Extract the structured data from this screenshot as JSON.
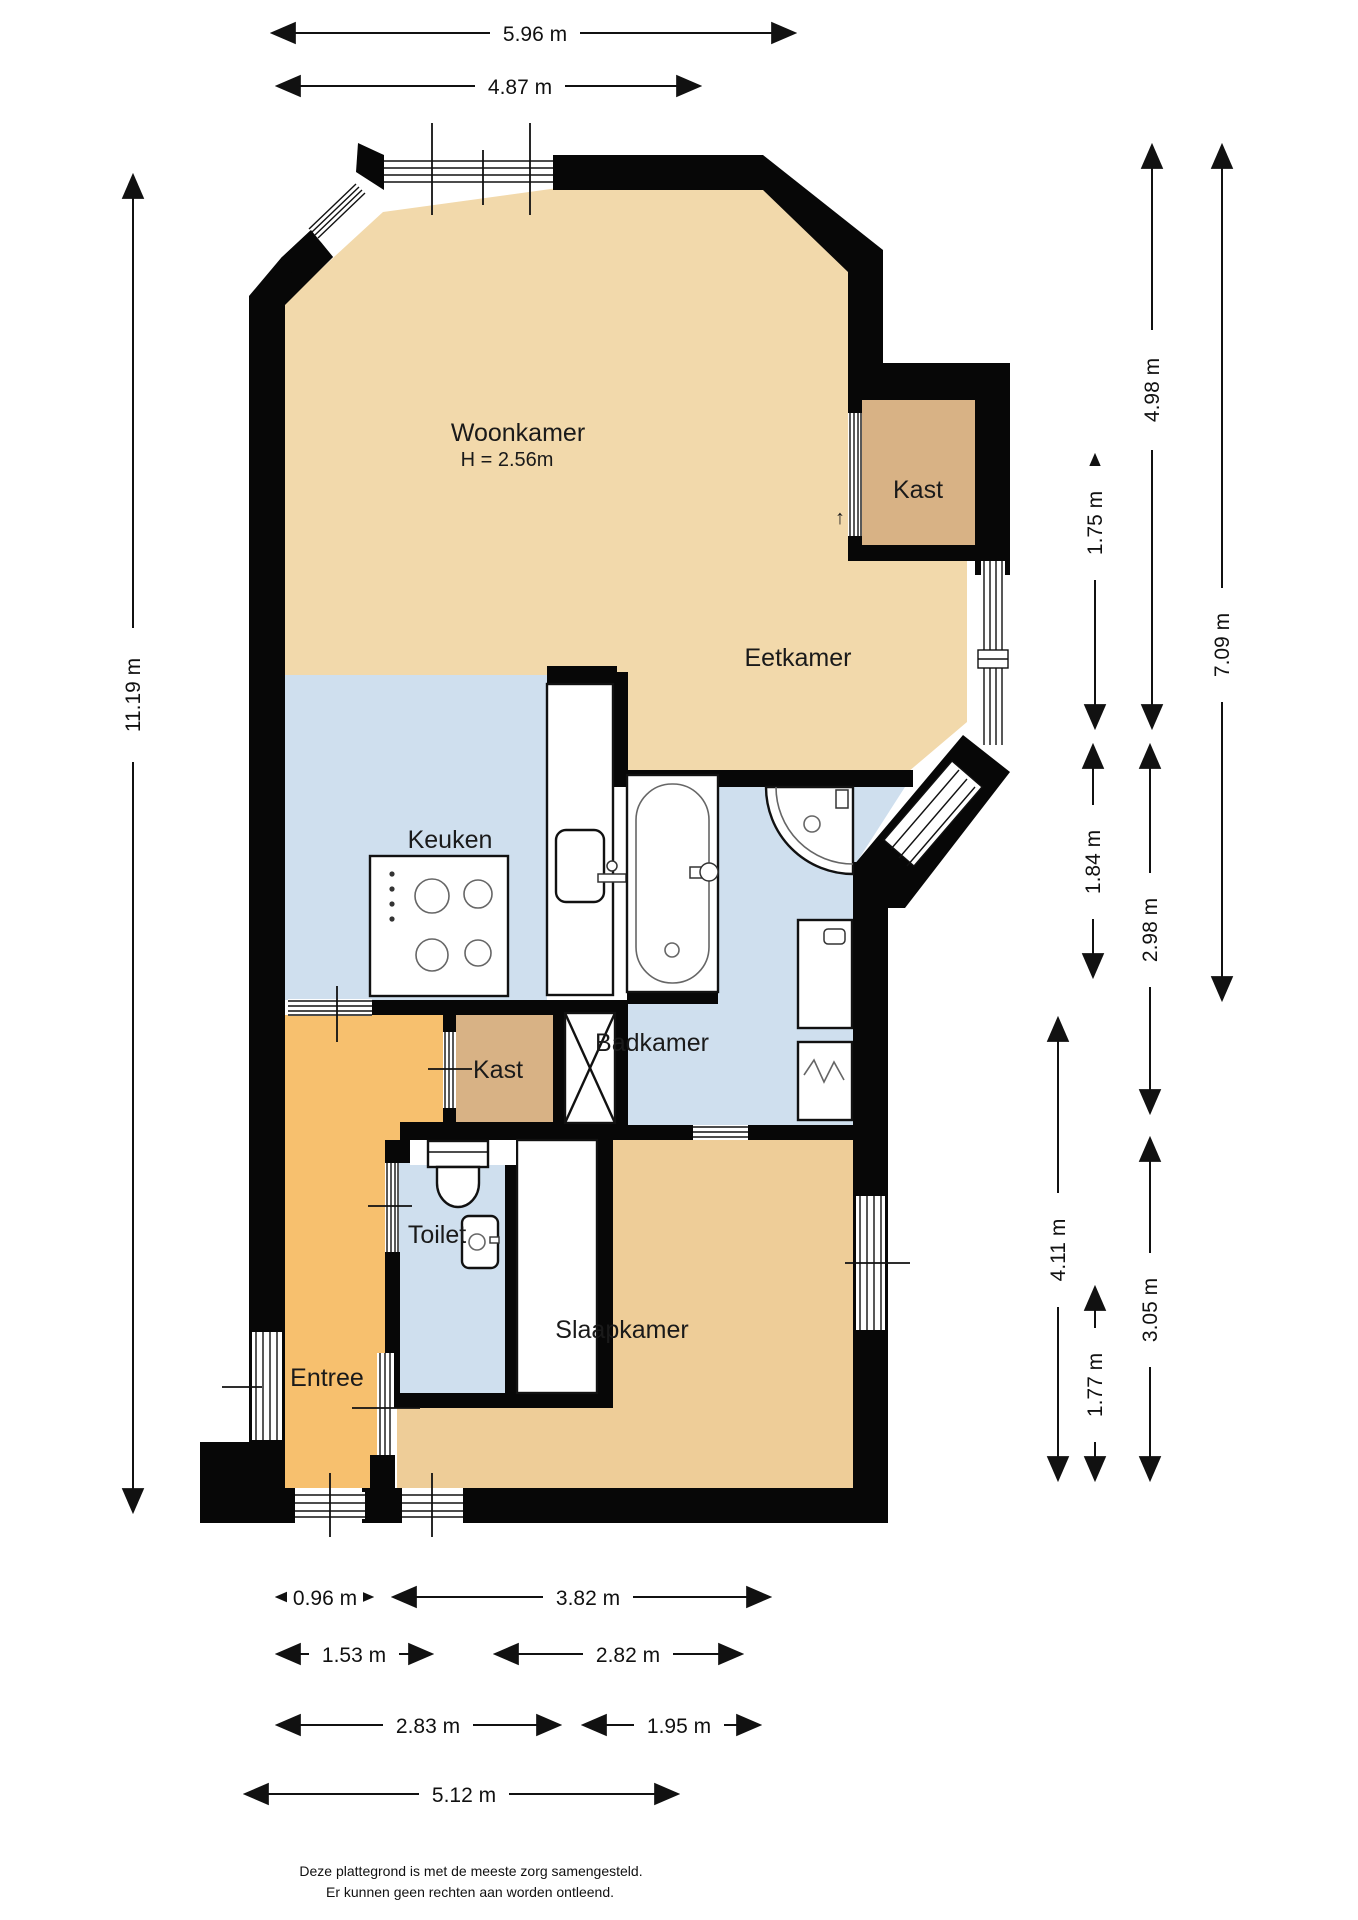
{
  "rooms": {
    "woonkamer": {
      "label": "Woonkamer",
      "height_note": "H = 2.56m"
    },
    "eetkamer": {
      "label": "Eetkamer"
    },
    "kast_boven": {
      "label": "Kast"
    },
    "keuken": {
      "label": "Keuken"
    },
    "badkamer": {
      "label": "Badkamer"
    },
    "kast_hal": {
      "label": "Kast"
    },
    "toilet": {
      "label": "Toilet"
    },
    "slaapkamer": {
      "label": "Slaapkamer"
    },
    "entree": {
      "label": "Entree"
    },
    "door_marker": "↑"
  },
  "dims": {
    "top_outer": "5.96 m",
    "top_inner": "4.87 m",
    "left_total": "11.19 m",
    "right_498": "4.98 m",
    "right_175": "1.75 m",
    "right_184": "1.84 m",
    "right_298": "2.98 m",
    "right_709": "7.09 m",
    "right_411": "4.11 m",
    "right_177": "1.77 m",
    "right_305": "3.05 m",
    "bottom_096": "0.96 m",
    "bottom_382": "3.82 m",
    "bottom_153": "1.53 m",
    "bottom_282": "2.82 m",
    "bottom_283": "2.83 m",
    "bottom_195": "1.95 m",
    "bottom_512": "5.12 m"
  },
  "footer": {
    "line1": "Deze plattegrond is met de meeste zorg samengesteld.",
    "line2": "Er kunnen geen rechten aan worden ontleend."
  },
  "colors": {
    "floor_living": "#f2d9ab",
    "floor_bedroom": "#eecd98",
    "floor_closet": "#d8b285",
    "floor_wet": "#cfdfee",
    "floor_hall": "#f7c06e",
    "wall": "#070707"
  }
}
